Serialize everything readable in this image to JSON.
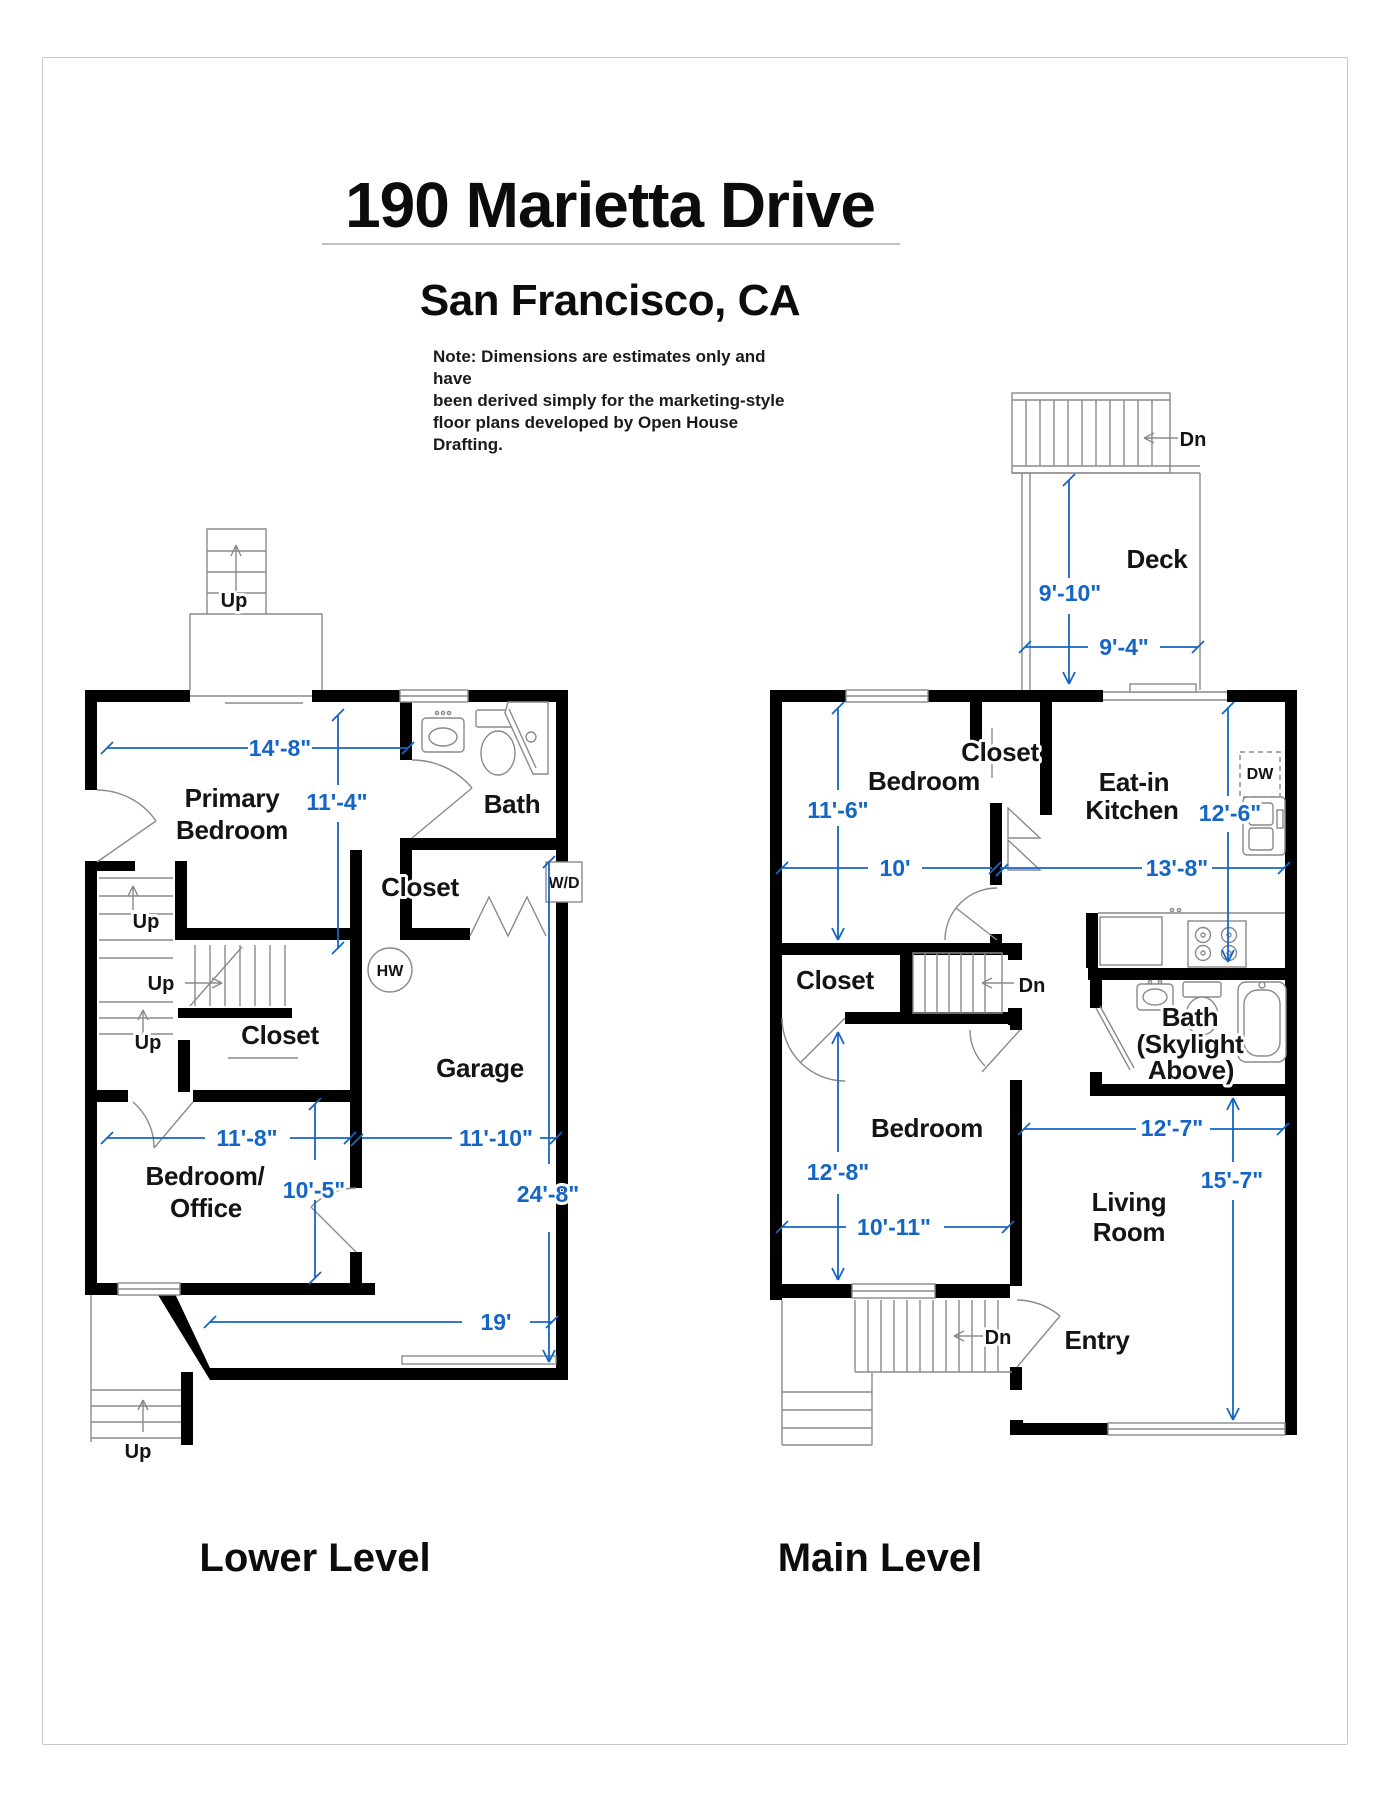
{
  "page": {
    "title": "190 Marietta Drive",
    "subtitle": "San Francisco, CA",
    "note_line1": "Note: Dimensions are estimates only and have",
    "note_line2": "been derived simply for the marketing-style",
    "note_line3": "floor plans developed by Open House Drafting."
  },
  "colors": {
    "dimension_blue": "#1566C4",
    "wall_black": "#000000",
    "thin_line_gray": "#8A8A8A"
  },
  "lower_level": {
    "title": "Lower Level",
    "labels": {
      "up_porch": "Up",
      "up_stair1": "Up",
      "up_stair2": "Up",
      "up_stair3": "Up",
      "up_exterior": "Up",
      "primary_bedroom_1": "Primary",
      "primary_bedroom_2": "Bedroom",
      "bath": "Bath",
      "closet_upper": "Closet",
      "closet_lower": "Closet",
      "wd": "W/D",
      "hw": "HW",
      "garage": "Garage",
      "bedroom_office_1": "Bedroom/",
      "bedroom_office_2": "Office"
    },
    "dimensions": {
      "primary_width": "14'-8\"",
      "primary_depth": "11'-4\"",
      "bedroom_office_width": "11'-8\"",
      "garage_width": "11'-10\"",
      "bedroom_office_depth": "10'-5\"",
      "garage_depth": "24'-8\"",
      "garage_length": "19'"
    }
  },
  "main_level": {
    "title": "Main Level",
    "labels": {
      "deck": "Deck",
      "dn_deck": "Dn",
      "dn_stairs": "Dn",
      "dn_entry": "Dn",
      "bedroom_top": "Bedroom",
      "closet_top": "Closet",
      "closet_mid": "Closet",
      "eat_in_kitchen_1": "Eat-in",
      "eat_in_kitchen_2": "Kitchen",
      "dw": "DW",
      "bath_1": "Bath",
      "bath_2": "(Skylight",
      "bath_3": "Above)",
      "bedroom_bottom": "Bedroom",
      "living_room_1": "Living",
      "living_room_2": "Room",
      "entry": "Entry"
    },
    "dimensions": {
      "deck_depth": "9'-10\"",
      "deck_width": "9'-4\"",
      "bedroom_top_depth": "11'-6\"",
      "bedroom_top_width": "10'",
      "kitchen_depth": "12'-6\"",
      "kitchen_width": "13'-8\"",
      "bedroom_bottom_depth": "12'-8\"",
      "bedroom_bottom_width": "10'-11\"",
      "living_width": "12'-7\"",
      "living_depth": "15'-7\""
    }
  }
}
